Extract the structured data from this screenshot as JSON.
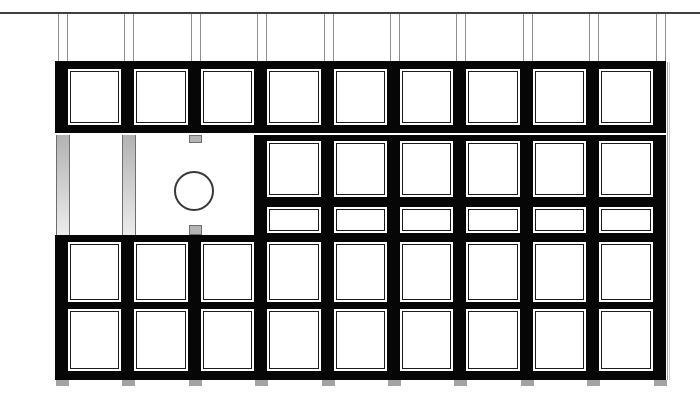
{
  "meta": {
    "description": "Monochrome architectural elevation drawing of a modular panel wall: 9-column grid of square framed panels, an open middle bay with gray vertical posts, a wide blank panel with a circular penetration and small gray connector tabs, a right middle section of tall and short sub-panels, two bottom panel rows, gray feet below each post line, a datum line across the top with paired guide lines, and a light shadow edge at right."
  },
  "canvas": {
    "width": 700,
    "height": 416,
    "background": "#ffffff"
  },
  "palette": {
    "frame": "#060606",
    "panel_fill": "#ffffff",
    "panel_line": "#1a1a1a",
    "post_top": "#b2b2b2",
    "post_bottom": "#ececec",
    "post_edge": "#6e6e6e",
    "tab_fill": "#b5b5b5",
    "foot": "#a3a3a3",
    "guide": "#8d8d8d",
    "datum": "#404040",
    "shadow_dark": "#9e9e9e",
    "shadow_light": "#cccccc",
    "circle_stroke": "#383838"
  },
  "grid": {
    "columns": 9,
    "post_count": 10,
    "first_post_x": 57,
    "pitch": 66.4,
    "post_width": 14,
    "mullion_left_offset": -2,
    "mullion_width": 13,
    "panel_left_offset": 11,
    "panel_width": 53.4
  },
  "datum_line": {
    "x": 0,
    "y": 12,
    "width": 700,
    "height": 2
  },
  "guides": {
    "y_top": 13.5,
    "y_bottom": 61,
    "offsets": [
      1,
      10
    ]
  },
  "row1": {
    "frame_y": 61,
    "frame_height": 72,
    "panel_y": 69,
    "panel_height": 55.5,
    "panel_columns": [
      0,
      1,
      2,
      3,
      4,
      5,
      6,
      7,
      8
    ]
  },
  "row2": {
    "top": 134.7,
    "bottom": 235,
    "open_post_columns": [
      0,
      1
    ],
    "post_y": 134.7,
    "post_height": 100.3,
    "tab_post_index": 2,
    "tab_width": 13,
    "tabs": [
      {
        "y": 134.7,
        "height": 8.3
      },
      {
        "y": 224.5,
        "height": 10.5
      }
    ],
    "circle": {
      "cx": 193.5,
      "cy": 190.5,
      "r": 20
    },
    "right_section": {
      "start_post": 3,
      "y": 134.5,
      "height": 100.5,
      "tall_panel": {
        "y": 141,
        "height": 55.5,
        "columns": [
          3,
          4,
          5,
          6,
          7,
          8
        ]
      },
      "short_panel": {
        "y": 206.5,
        "height": 26.5,
        "columns": [
          3,
          4,
          5,
          6,
          7,
          8
        ]
      }
    }
  },
  "row34": {
    "frame_y": 235,
    "frame_height": 144.5,
    "row3_panel": {
      "y": 242,
      "height": 59.5,
      "columns": [
        0,
        1,
        2,
        3,
        4,
        5,
        6,
        7,
        8
      ]
    },
    "row4_panel": {
      "y": 309,
      "height": 62,
      "columns": [
        0,
        1,
        2,
        3,
        4,
        5,
        6,
        7,
        8
      ]
    }
  },
  "feet": {
    "y": 379.5,
    "height": 6,
    "width": 13,
    "left_offset": -1,
    "post_indices": [
      0,
      1,
      2,
      3,
      4,
      5,
      6,
      7,
      8,
      9
    ]
  },
  "edge_shadow": {
    "y": 62,
    "height": 317.5,
    "lines": [
      {
        "x": 666.5,
        "width": 1.5,
        "color_key": "shadow_dark"
      },
      {
        "x": 669,
        "width": 1,
        "color_key": "shadow_light"
      }
    ]
  }
}
